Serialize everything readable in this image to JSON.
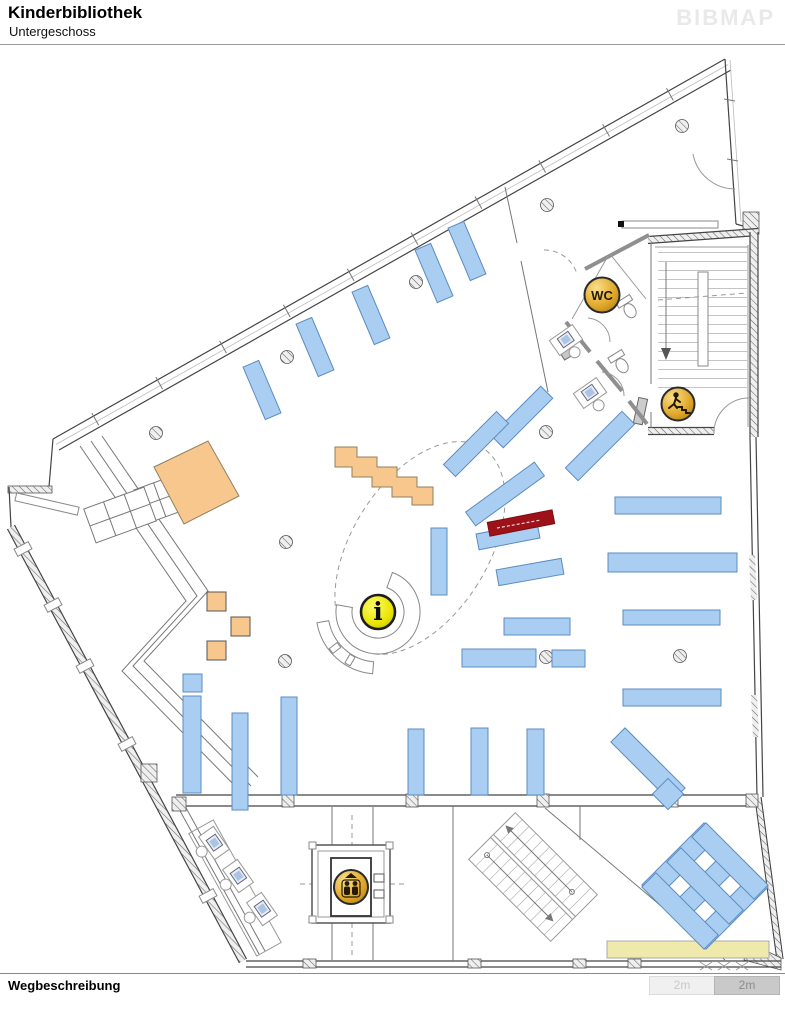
{
  "header": {
    "title": "Kinderbibliothek",
    "subtitle": "Untergeschoss",
    "logo": "BIBMAP"
  },
  "footer": {
    "label": "Wegbeschreibung"
  },
  "scalebar": {
    "left": "2m",
    "right": "2m"
  },
  "map": {
    "floor": "Untergeschoss",
    "icons": {
      "wc": {
        "label": "WC"
      },
      "info": {
        "label": "i"
      },
      "stairs_down": {
        "name": "stairs-down-marker"
      },
      "elevator": {
        "name": "elevator-marker"
      }
    },
    "colors": {
      "shelf": "#A9CEF2",
      "shelf_border": "#5C8CBF",
      "furniture_orange": "#F7C78E",
      "highlight_red": "#9E1118",
      "mat_yellow": "#EFE9AC",
      "icon_gold": "#D9A520",
      "info_yellow": "#E3E000"
    }
  }
}
